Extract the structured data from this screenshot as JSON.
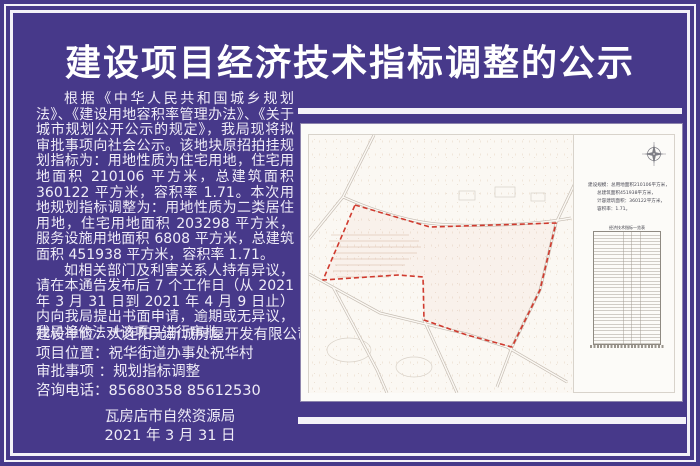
{
  "poster": {
    "title": "建设项目经济技术指标调整的公示",
    "body": {
      "para1": "根据《中华人民共和国城乡规划法》、《建设用地容积率管理办法》、《关于城市规划公开公示的规定》，我局现将拟审批事项向社会公示。该地块原招拍挂规划指标为：用地性质为住宅用地，住宅用地面积 210106 平方米，总建筑面积 360122 平方米，容积率 1.71。本次用地规划指标调整为：用地性质为二类居住用地，住宅用地面积 203298 平方米，服务设施用地面积 6808 平方米，总建筑面积 451938 平方米，容积率 1.71。",
      "para2": "如相关部门及利害关系人持有异议，请在本通告发布后 7 个工作日（从 2021 年 3 月 31 日到 2021 年 4 月 9 日止）内向我局提出书面申请，逾期或无异议，我局将依法对该项目进行审批。"
    },
    "info": [
      "建设单位：大连阳光新城房屋开发有限公司",
      "项目位置：祝华街道办事处祝华村",
      "审批事项 ：规划指标调整",
      "咨询电话：85680358  85612530"
    ],
    "footer": {
      "org": "瓦房店市自然资源局",
      "date": "2021 年 3 月 31 日"
    },
    "colors": {
      "background": "#47398a",
      "frame_white": "#f4f2f8",
      "text_white": "#efecf7",
      "boundary_red": "#d03a2e",
      "road_gray": "#c3bab0"
    }
  },
  "map": {
    "scale_lines": [
      "建设规模：总用地面积210106平方米，",
      "总建筑面积451938平方米，",
      "计容建筑面积：360122平方米，",
      "容积率：1.71。"
    ],
    "table_title": "经济技术指标一览表"
  }
}
